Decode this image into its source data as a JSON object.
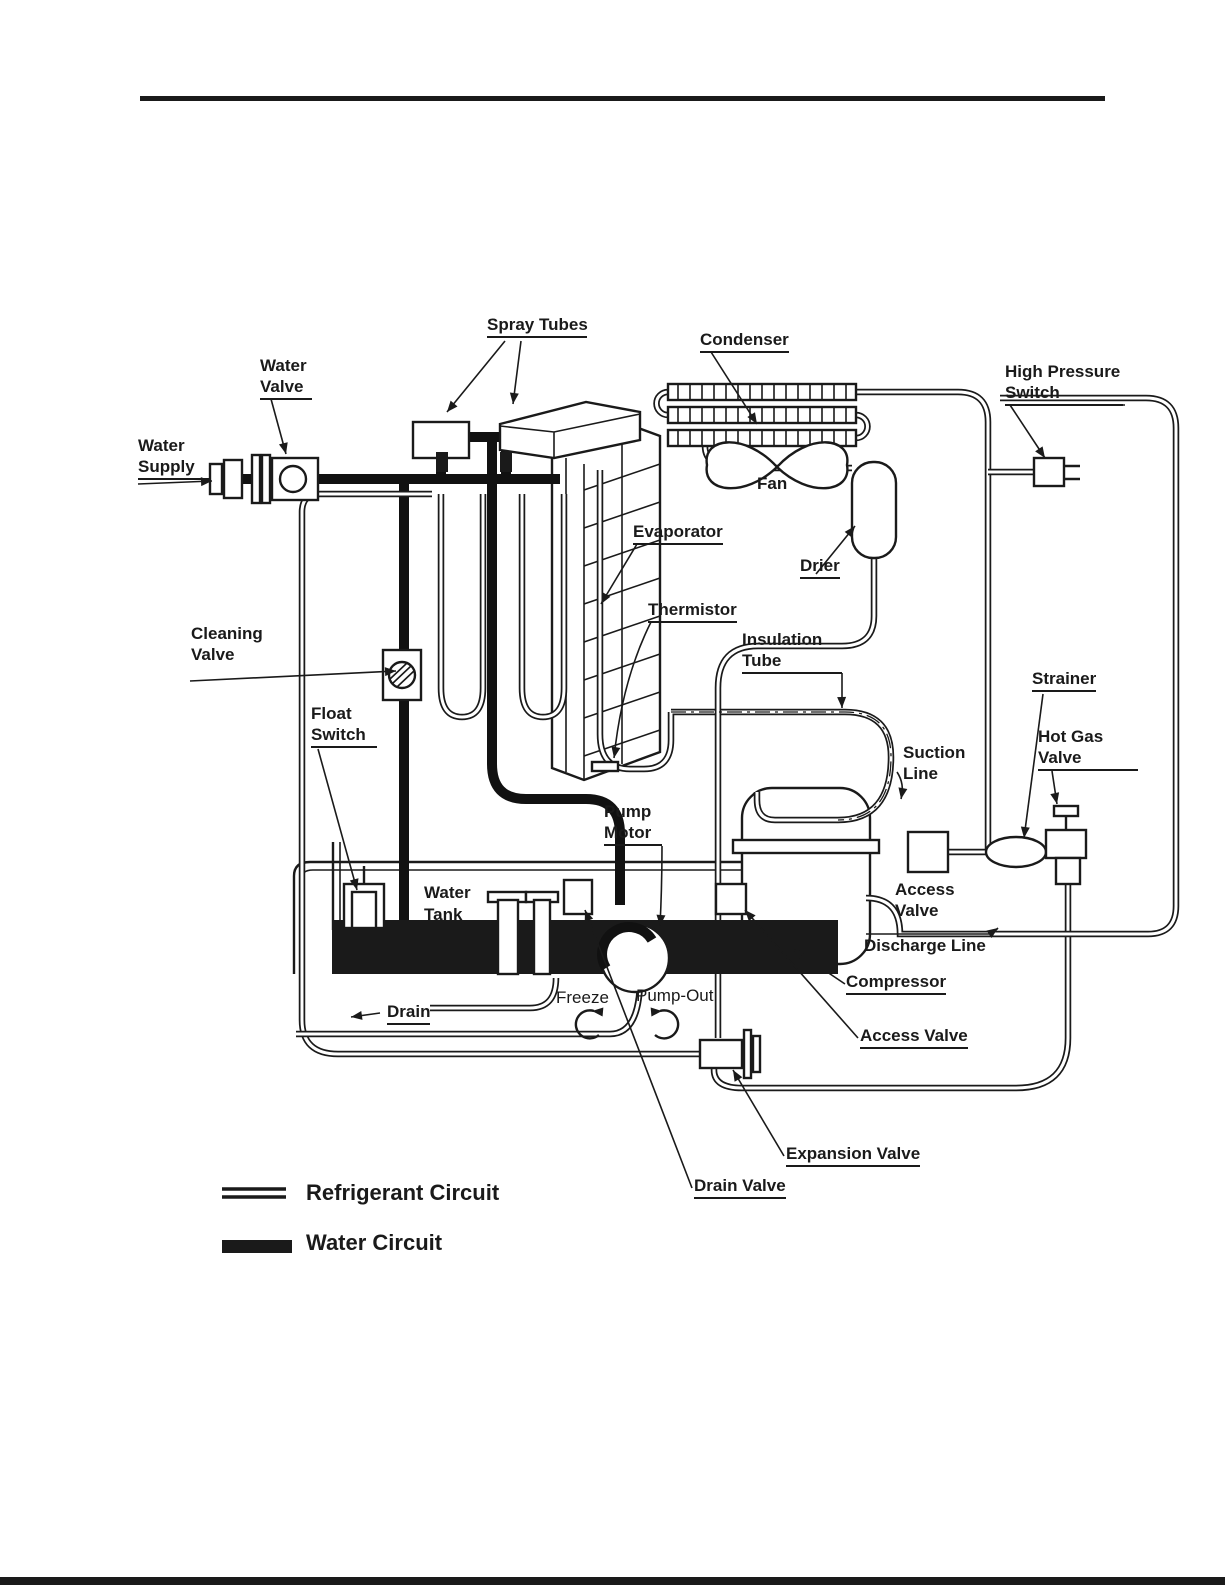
{
  "colors": {
    "ink": "#1a1a1a",
    "paper": "#ffffff"
  },
  "labels": {
    "spray_tubes": "Spray Tubes",
    "condenser": "Condenser",
    "high_pressure_switch": {
      "l1": "High Pressure",
      "l2": "Switch"
    },
    "water_valve": {
      "l1": "Water",
      "l2": "Valve"
    },
    "water_supply": {
      "l1": "Water",
      "l2": "Supply"
    },
    "fan": "Fan",
    "evaporator": "Evaporator",
    "drier": "Drier",
    "thermistor": "Thermistor",
    "insulation_tube": {
      "l1": "Insulation",
      "l2": "Tube"
    },
    "cleaning_valve": {
      "l1": "Cleaning",
      "l2": "Valve"
    },
    "strainer": "Strainer",
    "float_switch": {
      "l1": "Float",
      "l2": "Switch"
    },
    "suction_line": {
      "l1": "Suction",
      "l2": "Line"
    },
    "hot_gas_valve": {
      "l1": "Hot Gas",
      "l2": "Valve"
    },
    "pump_motor": {
      "l1": "Pump",
      "l2": "Motor"
    },
    "access_valve_top": {
      "l1": "Access",
      "l2": "Valve"
    },
    "water_tank": {
      "l1": "Water",
      "l2": "Tank"
    },
    "discharge_line": "Discharge Line",
    "compressor": "Compressor",
    "freeze": "Freeze",
    "pump_out": "Pump-Out",
    "drain": "Drain",
    "access_valve_bottom": "Access Valve",
    "expansion_valve": "Expansion Valve",
    "drain_valve": "Drain Valve"
  },
  "legend": {
    "refrigerant_label": "Refrigerant Circuit",
    "water_label": "Water Circuit"
  }
}
